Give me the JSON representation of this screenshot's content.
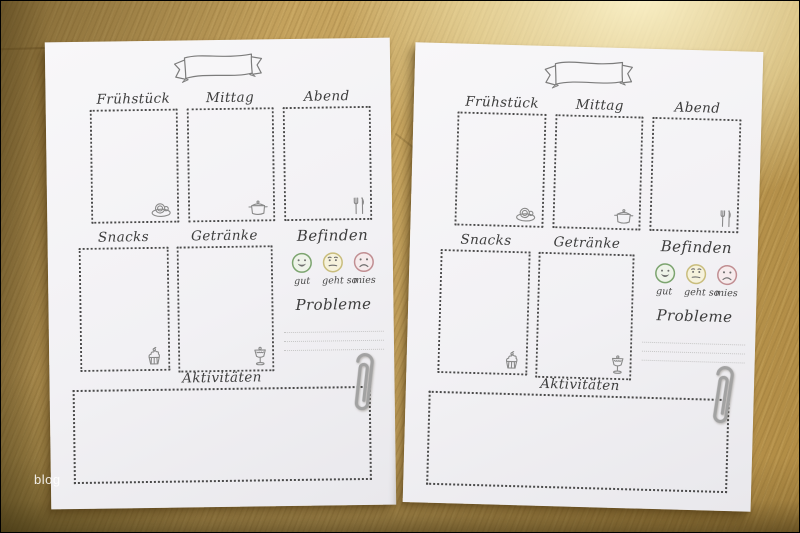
{
  "photo": {
    "watermark": "blog",
    "description": "Two identical printed German food-diary planner sheets lying on a wooden table"
  },
  "sheet": {
    "banner": {
      "icon": "ribbon-banner-icon",
      "label": ""
    },
    "meal_sections": [
      {
        "label": "Frühstück",
        "icon": "coffee-cup-icon"
      },
      {
        "label": "Mittag",
        "icon": "cooking-pot-icon"
      },
      {
        "label": "Abend",
        "icon": "fork-and-knife-icon"
      }
    ],
    "snack_section": {
      "label": "Snacks",
      "icon": "cupcake-icon"
    },
    "drink_section": {
      "label": "Getränke",
      "icon": "sundae-glass-icon"
    },
    "mood_section": {
      "title": "Befinden",
      "options": [
        {
          "label": "gut",
          "mood": "happy",
          "ring_color": "#7ca46f",
          "fill_color": "#eef3e9"
        },
        {
          "label": "geht so",
          "mood": "neutral",
          "ring_color": "#c9bd7d",
          "fill_color": "#f6f2dc"
        },
        {
          "label": "mies",
          "mood": "sad",
          "ring_color": "#c18e92",
          "fill_color": "#f6ebec"
        }
      ]
    },
    "problems_section": {
      "title": "Probleme",
      "lines": 3
    },
    "activities_section": {
      "label": "Aktivitäten"
    },
    "attachment": "paperclip"
  }
}
